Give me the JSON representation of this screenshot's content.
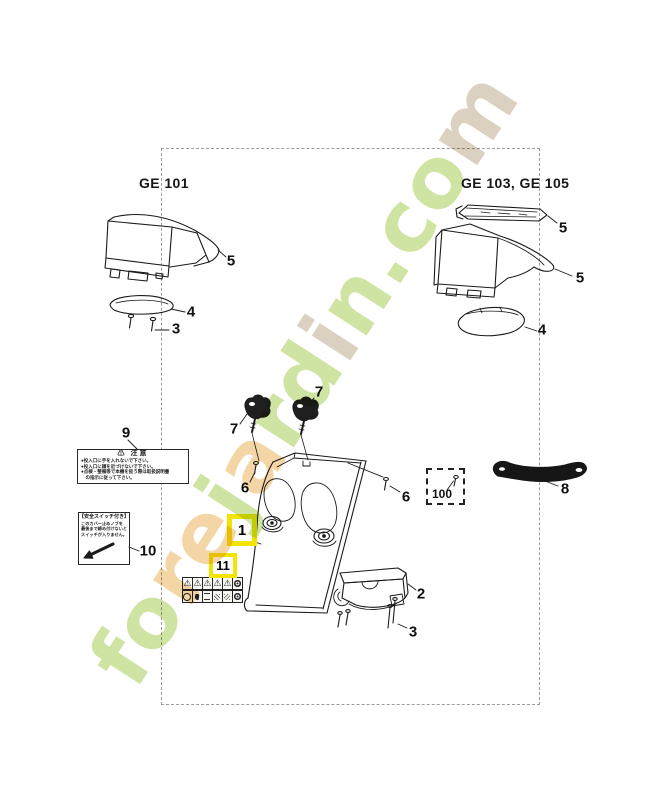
{
  "page": {
    "title_left": "GE 101",
    "title_right": "GE 103, GE 105"
  },
  "callouts": {
    "ge101_cover_5": "5",
    "ge101_plate_4": "4",
    "ge101_screw_3": "3",
    "ge103_rail_5": "5",
    "ge103_cover_5": "5",
    "ge103_plate_4": "4",
    "knob_left_7": "7",
    "knob_right_7": "7",
    "screw_left_6": "6",
    "screw_right_6": "6",
    "warning_label_9": "9",
    "switch_label_10": "10",
    "chute_1": "1",
    "sticker_11": "11",
    "switch_box_2": "2",
    "screw_bottom_3": "3",
    "seal_strip_8": "8",
    "hardware_kit_100": "100"
  },
  "warning_label_9": {
    "header": "⚠ 注意",
    "lines": [
      "●投入口に手を入れないで下さい。",
      "●投入口に顔を近づけないで下さい。",
      "●点検・整備等で本機を扱う際は取扱説明書",
      "　の指示に従って下さい。"
    ]
  },
  "switch_label_10": {
    "header": "【安全スイッチ付き】",
    "lines": [
      "このカバー止めノブを",
      "最後まで締め付けないと",
      "スイッチが入りません。"
    ]
  },
  "safety_sticker_11": {
    "top_row": [
      "warning-triangle-icon",
      "warning-triangle-icon",
      "warning-triangle-icon",
      "warning-triangle-icon",
      "warning-triangle-icon",
      "prohibition-badge-icon"
    ],
    "bottom_row": [
      "dial-badge-icon",
      "boot-badge-icon",
      "distance-badge-icon",
      "bystander-badge-icon",
      "ejecta-badge-icon",
      "shield-badge-icon"
    ]
  },
  "watermark": {
    "text": "forejardin.com",
    "colors": {
      "green": "#cbe29a",
      "orange": "#f4d29e",
      "tan": "#d8cdbb"
    },
    "letter_colors": [
      "green",
      "green",
      "orange",
      "orange",
      "green",
      "orange",
      "green",
      "green",
      "tan",
      "green",
      "green",
      "green",
      "green",
      "tan"
    ]
  },
  "style": {
    "highlight": "#f2e400",
    "line": "#1a1a1a",
    "frame_dash": "#9c9c9c"
  }
}
